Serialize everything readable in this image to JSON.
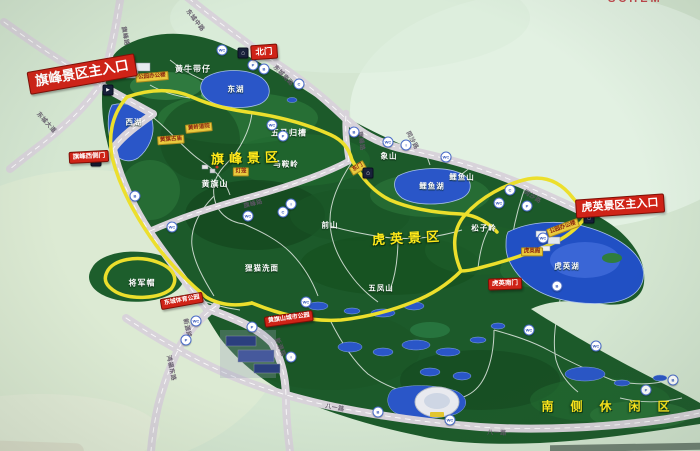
{
  "photo": {
    "title_fragment": "SCHEM"
  },
  "colors": {
    "background": "#d4e6d1",
    "forest": "#1c5a2a",
    "road": "#d8d3da",
    "scenic_path_yellow": "#ecdf2c",
    "lake_blue": "#2a56c8",
    "entrance_red": "#cf2317",
    "area_title_yellow": "#ffe81a",
    "tag_yellow": "#e9ca3e"
  },
  "banners": [
    {
      "id": "qifeng-main-entrance",
      "text": "旗峰景区主入口",
      "x": 82,
      "y": 74,
      "rot": -10,
      "fs": 13.5
    },
    {
      "id": "north-gate",
      "text": "北门",
      "x": 264,
      "y": 52,
      "rot": -4,
      "fs": 8.5
    },
    {
      "id": "qifeng-west-gate",
      "text": "旗峰西侧门",
      "x": 89,
      "y": 157,
      "rot": -3,
      "fs": 6.5
    },
    {
      "id": "huying-main-entrance",
      "text": "虎英景区主入口",
      "x": 620,
      "y": 206,
      "rot": -4,
      "fs": 11
    },
    {
      "id": "huying-south-gate",
      "text": "虎英南门",
      "x": 505,
      "y": 284,
      "rot": -2,
      "fs": 6.5
    },
    {
      "id": "dongcheng-sports-park",
      "text": "东城体育公园",
      "x": 182,
      "y": 301,
      "rot": -10,
      "fs": 6
    },
    {
      "id": "huangqishan-city-park",
      "text": "黄旗山城市公园",
      "x": 289,
      "y": 319,
      "rot": -8,
      "fs": 6
    }
  ],
  "area_titles": [
    {
      "id": "qifeng-area",
      "text": "旗峰景区",
      "x": 247,
      "y": 157,
      "rot": -2,
      "fs": 13,
      "ls": 5
    },
    {
      "id": "huying-area",
      "text": "虎英景区",
      "x": 408,
      "y": 237,
      "rot": -3,
      "fs": 13,
      "ls": 5
    },
    {
      "id": "south-leisure-area",
      "text": "南侧休闲区",
      "x": 614,
      "y": 406,
      "rot": 0,
      "fs": 12,
      "ls": 17
    }
  ],
  "features": [
    {
      "text": "黄牛带仔",
      "x": 193,
      "y": 69,
      "fs": 8
    },
    {
      "text": "东湖",
      "x": 236,
      "y": 89,
      "fs": 7.5
    },
    {
      "text": "西湖",
      "x": 134,
      "y": 122,
      "fs": 7.5
    },
    {
      "text": "五马归槽",
      "x": 289,
      "y": 133,
      "fs": 8
    },
    {
      "text": "马鞍岭",
      "x": 286,
      "y": 164,
      "fs": 7.5
    },
    {
      "text": "黄旗山",
      "x": 215,
      "y": 184,
      "fs": 8
    },
    {
      "text": "象山",
      "x": 389,
      "y": 156,
      "fs": 7.5
    },
    {
      "text": "鲤鱼湖",
      "x": 432,
      "y": 186,
      "fs": 7.5
    },
    {
      "text": "鲤鱼山",
      "x": 462,
      "y": 177,
      "fs": 7.5
    },
    {
      "text": "前山",
      "x": 330,
      "y": 225,
      "fs": 7.5
    },
    {
      "text": "狸猫洗面",
      "x": 262,
      "y": 268,
      "fs": 7.5
    },
    {
      "text": "五凤山",
      "x": 381,
      "y": 288,
      "fs": 7.5
    },
    {
      "text": "松子岭",
      "x": 484,
      "y": 228,
      "fs": 7.5
    },
    {
      "text": "虎英湖",
      "x": 567,
      "y": 266,
      "fs": 7.5
    },
    {
      "text": "将军帽",
      "x": 142,
      "y": 283,
      "fs": 8
    }
  ],
  "poi_tags": [
    {
      "text": "公园办公楼",
      "x": 152,
      "y": 77,
      "rot": -5
    },
    {
      "text": "黄岭道院",
      "x": 199,
      "y": 128,
      "rot": -6
    },
    {
      "text": "黄旗古庙",
      "x": 171,
      "y": 140,
      "rot": -4
    },
    {
      "text": "灯笼",
      "x": 241,
      "y": 172,
      "rot": 0
    },
    {
      "text": "东门",
      "x": 358,
      "y": 168,
      "rot": -30
    },
    {
      "text": "公园办公楼",
      "x": 563,
      "y": 228,
      "rot": -20
    },
    {
      "text": "虎英阁",
      "x": 532,
      "y": 252,
      "rot": 0
    }
  ],
  "road_labels": [
    {
      "text": "旗峰路",
      "x": 126,
      "y": 36,
      "rot": 80
    },
    {
      "text": "东城大道",
      "x": 47,
      "y": 122,
      "rot": 48
    },
    {
      "text": "东城中路",
      "x": 196,
      "y": 20,
      "rot": 52
    },
    {
      "text": "东城南路",
      "x": 284,
      "y": 75,
      "rot": 46
    },
    {
      "text": "同沙路",
      "x": 413,
      "y": 140,
      "rot": 62
    },
    {
      "text": "同沙路",
      "x": 533,
      "y": 196,
      "rot": 32
    },
    {
      "text": "旗峰路",
      "x": 362,
      "y": 141,
      "rot": 82
    },
    {
      "text": "旗峰路",
      "x": 253,
      "y": 203,
      "rot": -14
    },
    {
      "text": "新源路",
      "x": 188,
      "y": 328,
      "rot": 78
    },
    {
      "text": "新源路",
      "x": 281,
      "y": 347,
      "rot": 68
    },
    {
      "text": "鸿福东路",
      "x": 172,
      "y": 368,
      "rot": 78
    },
    {
      "text": "八一路",
      "x": 335,
      "y": 407,
      "rot": 10
    },
    {
      "text": "八一路",
      "x": 497,
      "y": 432,
      "rot": 2
    }
  ],
  "marker_glyphs": {
    "parking": "P",
    "toilet": "WC",
    "bus": "B",
    "camera": "C",
    "info": "i",
    "gate": "⌂",
    "arrow": "►"
  },
  "markers": [
    {
      "kind": "arrow",
      "x": 108,
      "y": 90
    },
    {
      "kind": "arrow",
      "x": 96,
      "y": 161
    },
    {
      "kind": "gate",
      "x": 243,
      "y": 53
    },
    {
      "kind": "gate",
      "x": 368,
      "y": 173
    },
    {
      "kind": "gate",
      "x": 589,
      "y": 218
    },
    {
      "kind": "toilet",
      "x": 222,
      "y": 50
    },
    {
      "kind": "parking",
      "x": 253,
      "y": 65
    },
    {
      "kind": "bus",
      "x": 264,
      "y": 69
    },
    {
      "kind": "camera",
      "x": 299,
      "y": 84
    },
    {
      "kind": "toilet",
      "x": 272,
      "y": 125
    },
    {
      "kind": "parking",
      "x": 283,
      "y": 136
    },
    {
      "kind": "bus",
      "x": 354,
      "y": 132
    },
    {
      "kind": "toilet",
      "x": 388,
      "y": 142
    },
    {
      "kind": "info",
      "x": 406,
      "y": 145
    },
    {
      "kind": "toilet",
      "x": 446,
      "y": 157
    },
    {
      "kind": "camera",
      "x": 510,
      "y": 190
    },
    {
      "kind": "toilet",
      "x": 499,
      "y": 203
    },
    {
      "kind": "parking",
      "x": 527,
      "y": 206
    },
    {
      "kind": "toilet",
      "x": 543,
      "y": 238
    },
    {
      "kind": "bus",
      "x": 557,
      "y": 286
    },
    {
      "kind": "bus",
      "x": 135,
      "y": 196
    },
    {
      "kind": "toilet",
      "x": 172,
      "y": 227
    },
    {
      "kind": "toilet",
      "x": 248,
      "y": 216
    },
    {
      "kind": "camera",
      "x": 283,
      "y": 212
    },
    {
      "kind": "info",
      "x": 291,
      "y": 204
    },
    {
      "kind": "toilet",
      "x": 196,
      "y": 321
    },
    {
      "kind": "parking",
      "x": 186,
      "y": 340
    },
    {
      "kind": "parking",
      "x": 252,
      "y": 327
    },
    {
      "kind": "toilet",
      "x": 306,
      "y": 302
    },
    {
      "kind": "info",
      "x": 291,
      "y": 357
    },
    {
      "kind": "bus",
      "x": 378,
      "y": 412
    },
    {
      "kind": "toilet",
      "x": 450,
      "y": 420
    },
    {
      "kind": "toilet",
      "x": 529,
      "y": 330
    },
    {
      "kind": "toilet",
      "x": 596,
      "y": 346
    },
    {
      "kind": "parking",
      "x": 646,
      "y": 390
    },
    {
      "kind": "bus",
      "x": 673,
      "y": 380
    }
  ]
}
